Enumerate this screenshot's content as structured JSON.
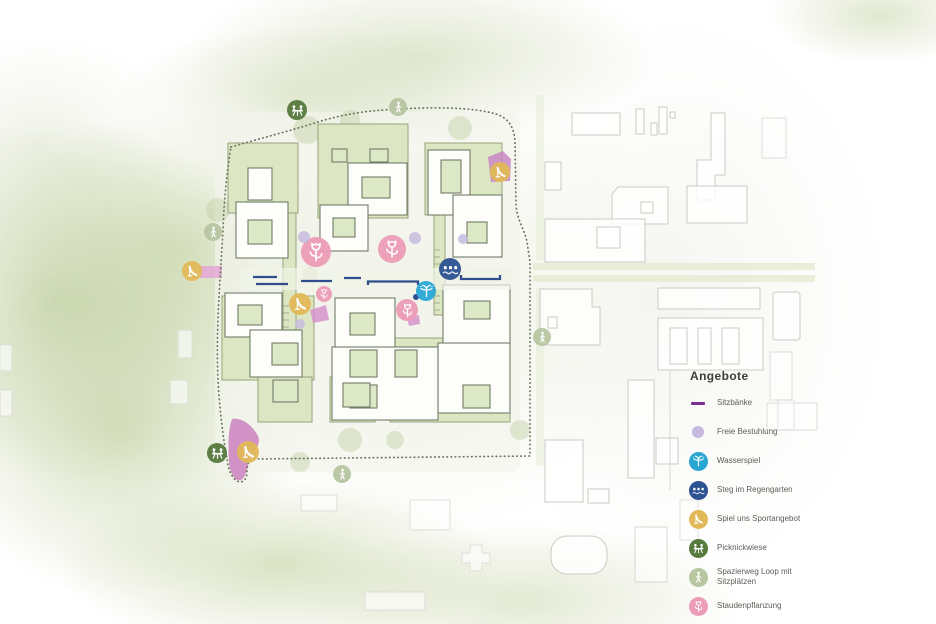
{
  "legend": {
    "title": "Angebote",
    "items": [
      {
        "type": "sitzbank",
        "label": "Sitzbänke"
      },
      {
        "type": "freie-bestuhlung",
        "label": "Freie Bestuhlung"
      },
      {
        "type": "wasserspiel",
        "label": "Wasserspiel"
      },
      {
        "type": "steg",
        "label": "Steg im Regengarten"
      },
      {
        "type": "spiel-sport",
        "label": "Spiel uns Sportangebot"
      },
      {
        "type": "picknickwiese",
        "label": "Picknickwiese"
      },
      {
        "type": "spazierweg",
        "label": "Spazierweg Loop mit Sitzplätzen"
      },
      {
        "type": "staudenpflanzung",
        "label": "Staudenpflanzung"
      }
    ]
  },
  "colors": {
    "sitzbank": "#7b2f95",
    "freie-bestuhlung": "#c6bbdf",
    "wasserspiel": "#2aa6d5",
    "steg": "#2c5291",
    "spiel-sport": "#e2b958",
    "picknickwiese": "#56793e",
    "spazierweg": "#b8c6a2",
    "staudenpflanzung": "#ec9cb7",
    "bench_line": "#2f4e8e",
    "boundary_dots": "#6d7560",
    "plot_green": "#dde6c3",
    "plot_stroke": "#8e9c72",
    "building_stroke": "#707c68",
    "context_stroke": "#c8ccc2",
    "planting_area_pink": "#cb80c0"
  },
  "markers": [
    {
      "type": "picknickwiese",
      "x": 297,
      "y": 110,
      "r": 10
    },
    {
      "type": "spazierweg",
      "x": 398,
      "y": 107,
      "r": 9
    },
    {
      "type": "spazierweg",
      "x": 213,
      "y": 232,
      "r": 9
    },
    {
      "type": "spiel-sport",
      "x": 192,
      "y": 271,
      "r": 10
    },
    {
      "type": "spiel-sport",
      "x": 500,
      "y": 172,
      "r": 10
    },
    {
      "type": "staudenpflanzung",
      "x": 316,
      "y": 252,
      "r": 15
    },
    {
      "type": "staudenpflanzung",
      "x": 392,
      "y": 249,
      "r": 14
    },
    {
      "type": "freie-bestuhlung",
      "x": 304,
      "y": 237,
      "r": 6
    },
    {
      "type": "freie-bestuhlung",
      "x": 415,
      "y": 238,
      "r": 6
    },
    {
      "type": "freie-bestuhlung",
      "x": 300,
      "y": 324,
      "r": 5
    },
    {
      "type": "freie-bestuhlung",
      "x": 463,
      "y": 239,
      "r": 5
    },
    {
      "type": "steg",
      "x": 450,
      "y": 269,
      "r": 11
    },
    {
      "type": "wasserspiel",
      "x": 426,
      "y": 291,
      "r": 10
    },
    {
      "type": "spiel-sport",
      "x": 300,
      "y": 304,
      "r": 11
    },
    {
      "type": "staudenpflanzung",
      "x": 324,
      "y": 294,
      "r": 8
    },
    {
      "type": "staudenpflanzung",
      "x": 407,
      "y": 310,
      "r": 11
    },
    {
      "type": "picknickwiese",
      "x": 217,
      "y": 453,
      "r": 10
    },
    {
      "type": "spiel-sport",
      "x": 248,
      "y": 452,
      "r": 11
    },
    {
      "type": "spazierweg",
      "x": 342,
      "y": 474,
      "r": 9
    },
    {
      "type": "spazierweg",
      "x": 542,
      "y": 337,
      "r": 9
    }
  ]
}
